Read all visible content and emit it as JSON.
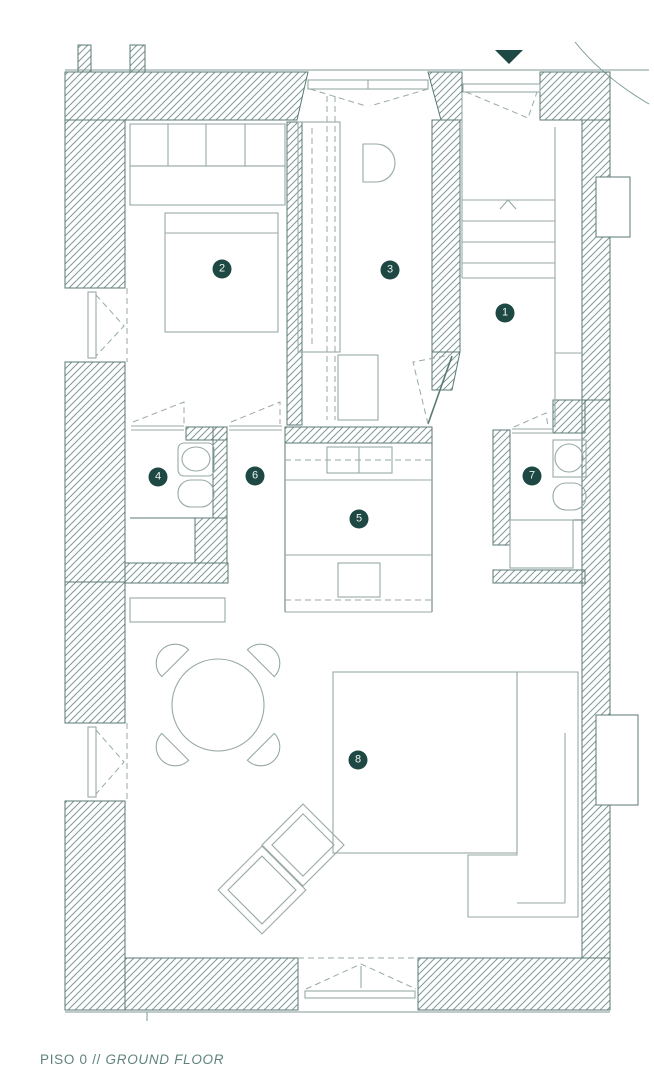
{
  "caption": {
    "floor_label": "PISO 0",
    "separator": "//",
    "floor_label_translation": "GROUND FLOOR"
  },
  "rooms": [
    {
      "number": "1",
      "x": 505,
      "y": 313
    },
    {
      "number": "2",
      "x": 222,
      "y": 269
    },
    {
      "number": "3",
      "x": 390,
      "y": 270
    },
    {
      "number": "4",
      "x": 158,
      "y": 477
    },
    {
      "number": "5",
      "x": 359,
      "y": 519
    },
    {
      "number": "6",
      "x": 255,
      "y": 476
    },
    {
      "number": "7",
      "x": 532,
      "y": 476
    },
    {
      "number": "8",
      "x": 358,
      "y": 760
    }
  ],
  "icons": {
    "entrance_marker": "down-triangle"
  },
  "colors": {
    "wall_line": "#5b7a76",
    "hatch": "#7f9a96",
    "furniture_line": "#98a9a6",
    "accent_dark": "#1e4843",
    "caption_text": "#5f827e",
    "background": "#ffffff"
  }
}
